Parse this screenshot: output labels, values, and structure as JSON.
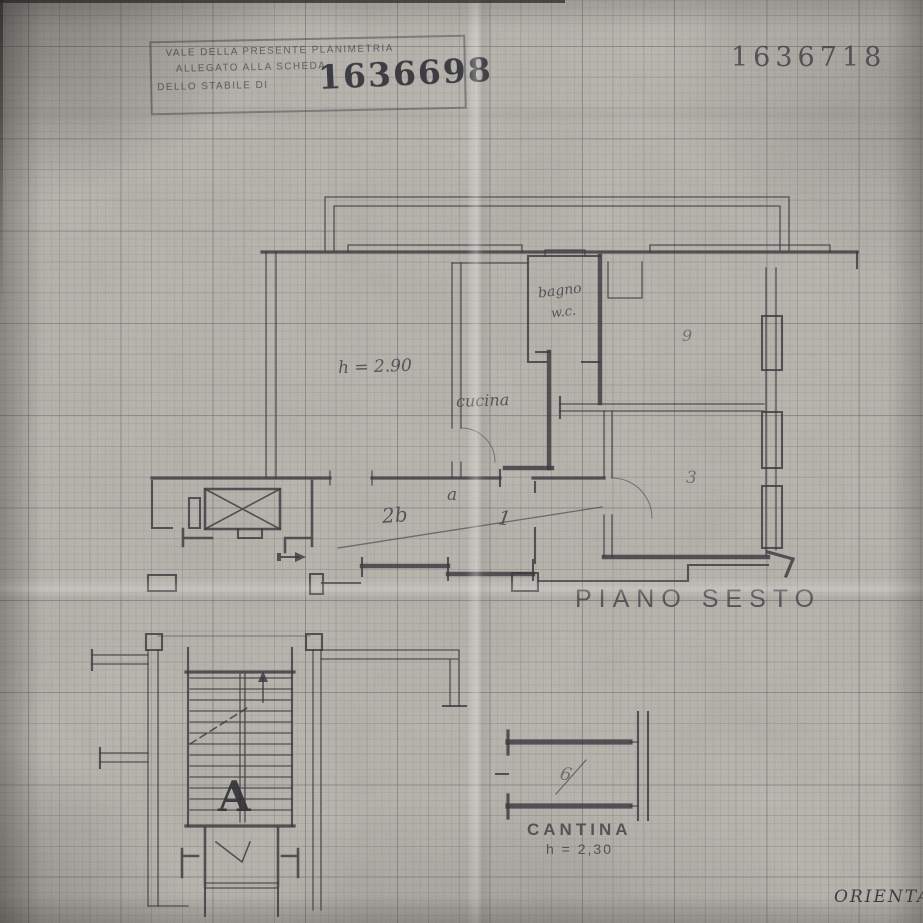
{
  "stamp": {
    "line1": "VALE DELLA PRESENTE PLANIMETRIA",
    "line2": "ALLEGATO ALLA SCHEDA",
    "line3": "DELLO STABILE DI",
    "number": "1636698"
  },
  "ref_number": "1636718",
  "plan": {
    "floor_label": "PIANO SESTO",
    "height_note": "h = 2.90",
    "kitchen_label": "cucina",
    "bathroom_label": "bagno",
    "bathroom_wc": "w.c.",
    "marks": {
      "hall": "2b",
      "entry": "a",
      "vestibule": "1",
      "room_right": "9",
      "room_lower": "3"
    }
  },
  "stairs": {
    "letter": "A"
  },
  "cellar": {
    "label": "CANTINA",
    "height_note": "h = 2,30",
    "mark": "6"
  },
  "orientation_label": "ORIENTA",
  "colors": {
    "paper": "#cfccc5",
    "ink": "#3b3a40",
    "grid": "#8a8880",
    "shadow": "#5a5852"
  }
}
